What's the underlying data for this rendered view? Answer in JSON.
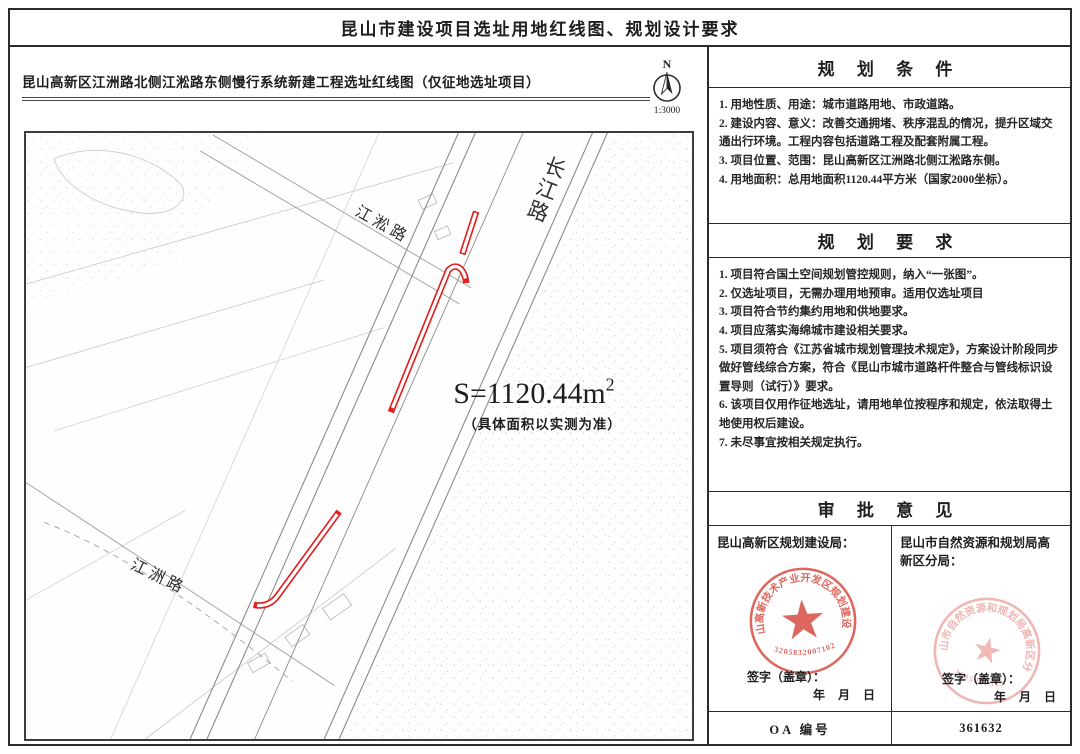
{
  "page": {
    "title": "昆山市建设项目选址用地红线图、规划设计要求"
  },
  "map_panel": {
    "title": "昆山高新区江洲路北侧江淞路东侧慢行系统新建工程选址红线图（仅征地选址项目）",
    "north_label": "N",
    "scale": "1:3000",
    "area_label": "S=1120.44m",
    "area_sup": "2",
    "area_note": "（具体面积以实测为准）",
    "roads": {
      "changjiang": "长江路",
      "jiangsong": "江淞路",
      "jiangzhou": "江洲路"
    }
  },
  "planning_conditions": {
    "title": "规 划 条 件",
    "items": [
      "1. 用地性质、用途：城市道路用地、市政道路。",
      "2. 建设内容、意义：改善交通拥堵、秩序混乱的情况，提升区域交通出行环境。工程内容包括道路工程及配套附属工程。",
      "3. 项目位置、范围：昆山高新区江洲路北侧江淞路东侧。",
      "4. 用地面积：总用地面积1120.44平方米（国家2000坐标）。"
    ]
  },
  "planning_requirements": {
    "title": "规 划 要 求",
    "items": [
      "1. 项目符合国土空间规划管控规则，纳入“一张图”。",
      "2. 仅选址项目，无需办理用地预审。适用仅选址项目",
      "3. 项目符合节约集约用地和供地要求。",
      "4. 项目应落实海绵城市建设相关要求。",
      "5. 项目须符合《江苏省城市规划管理技术规定》，方案设计阶段同步做好管线综合方案，符合《昆山市城市道路杆件整合与管线标识设置导则（试行）》要求。",
      "6. 该项目仅用作征地选址，请用地单位按程序和规定，依法取得土地使用权后建设。",
      "7. 未尽事宜按相关规定执行。"
    ]
  },
  "approval": {
    "title": "审 批 意 见",
    "left": {
      "agency": "昆山高新区规划建设局：",
      "seal_text": "昆山高新技术产业开发区规划建设局",
      "seal_number": "3205832007102",
      "sign_label": "签字（盖章）：",
      "date_label": "年 月 日"
    },
    "right": {
      "agency": "昆山市自然资源和规划局高新区分局：",
      "seal_text": "昆山市自然资源和规划局高新区分局",
      "seal_number": "3205832317",
      "sign_label": "签字（盖章）：",
      "date_label": "年 月 日"
    }
  },
  "footer": {
    "oa_label": "OA 编号",
    "oa_number": "361632"
  },
  "colors": {
    "redline": "#e02020",
    "seal_red": "#d95348",
    "seal_pink": "#e99a95"
  }
}
